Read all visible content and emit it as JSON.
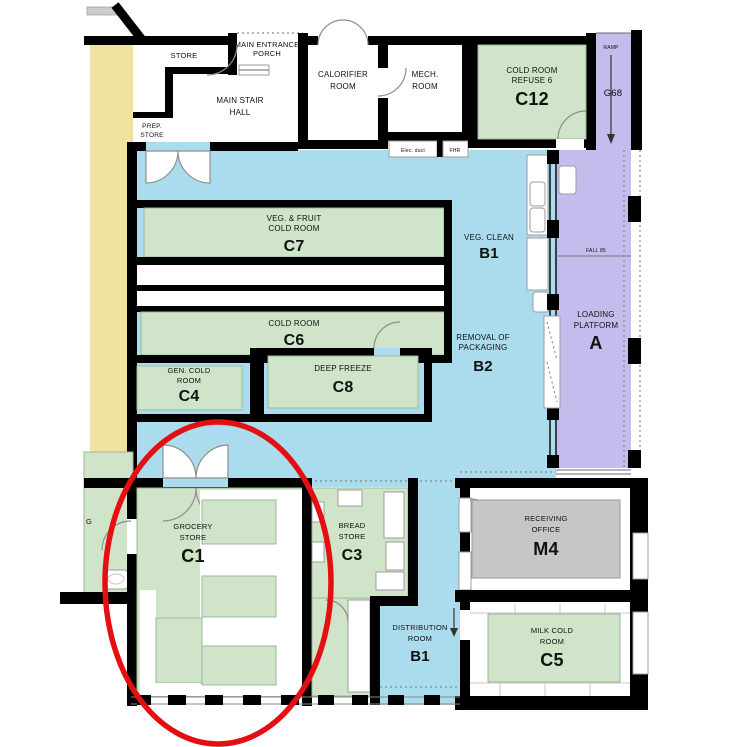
{
  "colors": {
    "cold_room_green": "#cfe4c9",
    "circulation_blue": "#abdcee",
    "platform_purple": "#c3bcec",
    "service_yellow": "#f2e2a2",
    "office_gray": "#c6c6c6",
    "wall_black": "#000000",
    "annotation_red": "#e40f12"
  },
  "annotation": {
    "shape": "ellipse",
    "color": "#e40f12",
    "highlights": "C1"
  },
  "rooms": {
    "store": {
      "lines": [
        "STORE"
      ]
    },
    "porch": {
      "lines": [
        "MAIN ENTRANCE",
        "PORCH"
      ]
    },
    "stair_hall": {
      "lines": [
        "MAIN STAIR",
        "HALL"
      ]
    },
    "prep_store": {
      "lines": [
        "PREP.",
        "STORE"
      ]
    },
    "calorifier": {
      "lines": [
        "CALORIFIER",
        "ROOM"
      ]
    },
    "mech": {
      "lines": [
        "MECH.",
        "ROOM"
      ]
    },
    "elec_duct": {
      "lines": [
        "Elec. duct"
      ]
    },
    "fhr": {
      "lines": [
        "FHR"
      ]
    },
    "c12": {
      "lines": [
        "COLD ROOM",
        "REFUSE 6"
      ],
      "code": "C12"
    },
    "ramp": {
      "lines": [
        "RAMP"
      ]
    },
    "g68": {
      "lines": [
        "G68"
      ]
    },
    "c7": {
      "lines": [
        "VEG. & FRUIT",
        "COLD ROOM"
      ],
      "code": "C7"
    },
    "veg_clean": {
      "lines": [
        "VEG. CLEAN"
      ],
      "code": "B1"
    },
    "c6": {
      "lines": [
        "COLD ROOM"
      ],
      "code": "C6"
    },
    "removal": {
      "lines": [
        "REMOVAL OF",
        "PACKAGING"
      ],
      "code": "B2"
    },
    "loading": {
      "lines": [
        "LOADING",
        "PLATFORM"
      ],
      "code": "A"
    },
    "fall": {
      "lines": [
        "FALL 85"
      ]
    },
    "c4": {
      "lines": [
        "GEN. COLD",
        "ROOM"
      ],
      "code": "C4"
    },
    "c8": {
      "lines": [
        "DEEP FREEZE"
      ],
      "code": "C8"
    },
    "left_partial": {
      "lines": [
        "G"
      ]
    },
    "c1": {
      "lines": [
        "GROCERY",
        "STORE"
      ],
      "code": "C1"
    },
    "c3": {
      "lines": [
        "BREAD",
        "STORE"
      ],
      "code": "C3"
    },
    "m4": {
      "lines": [
        "RECEIVING",
        "OFFICE"
      ],
      "code": "M4"
    },
    "distribution": {
      "lines": [
        "DISTRIBUTION",
        "ROOM"
      ],
      "code": "B1"
    },
    "c5": {
      "lines": [
        "MILK COLD",
        "ROOM"
      ],
      "code": "C5"
    }
  }
}
